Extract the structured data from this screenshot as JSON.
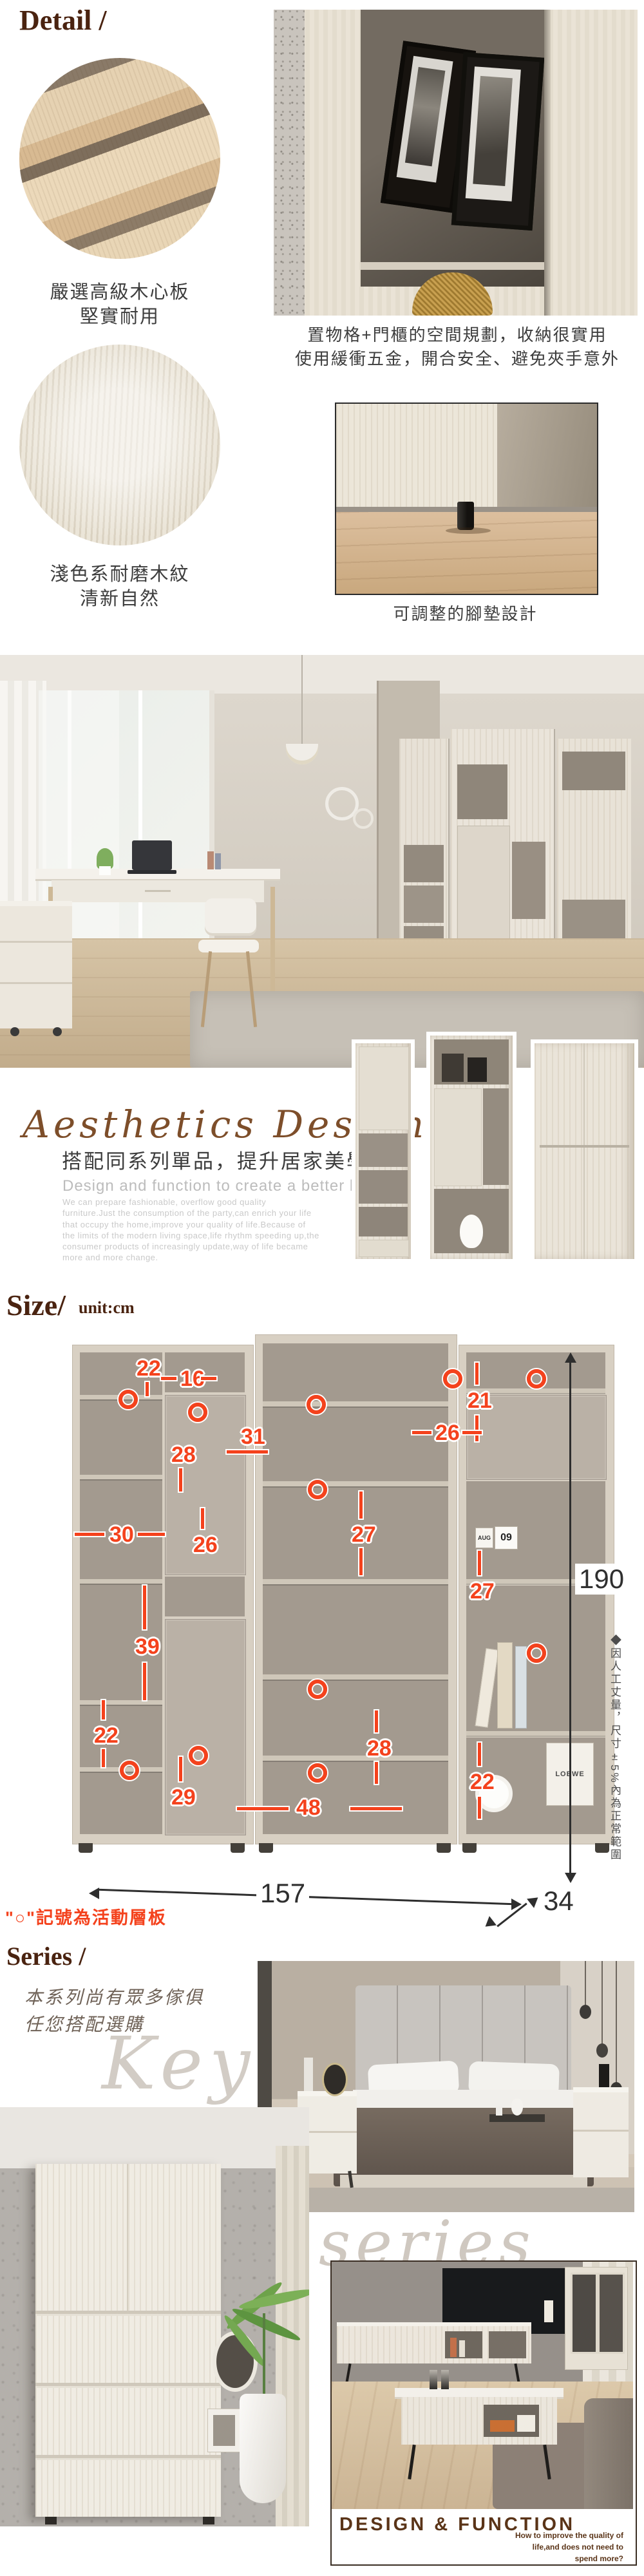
{
  "detail": {
    "title": "Detail /",
    "material_captions": [
      {
        "line1": "嚴選高級木心板",
        "line2": "堅實耐用"
      },
      {
        "line1": "淺色系耐磨木紋",
        "line2": "清新自然"
      }
    ],
    "photo_caption_1a": "置物格+門櫃的空間規劃，收納很實用",
    "photo_caption_1b": "使用緩衝五金，開合安全、避免夾手意外",
    "photo_caption_2": "可調整的腳墊設計"
  },
  "aesthetics": {
    "script_title": "Aesthetics Design",
    "headline": "搭配同系列單品，提升居家美學",
    "subheadline": "Design and function to create a better life.",
    "paragraph": "We can prepare fashionable, overflow good quality furniture.Just the consumption of the party,can enrich your life that occupy the home,improve your quality of life.Because of the limits of the modern living space,life rhythm speeding up,the consumer products of increasingly update,way of life became more and more change."
  },
  "size": {
    "title": "Size/",
    "unit": "unit:cm",
    "overall": {
      "width": "157",
      "depth": "34",
      "height": "190"
    },
    "dims": [
      "22",
      "16",
      "28",
      "31",
      "21",
      "26",
      "30",
      "26",
      "27",
      "39",
      "27",
      "22",
      "29",
      "48",
      "28",
      "22"
    ],
    "red_note": "\"○\"記號為活動層板",
    "vertical_note": "◆因人工丈量，尺寸±5%內為正常範圍",
    "accent_red": "#f4421d",
    "props": {
      "calendar_month": "AUG",
      "calendar_day": "09",
      "clock_brand": "LOEWE"
    }
  },
  "series": {
    "title": "Series /",
    "desc_line1": "本系列尚有眾多傢俱",
    "desc_line2": "任您搭配選購",
    "watermark_1": "Keya",
    "watermark_2": "series",
    "footer_title": "DESIGN & FUNCTION",
    "footer_line1": "How to improve the quality of",
    "footer_line2": "life,and does not need to",
    "footer_line3": "spend more?"
  },
  "colors": {
    "title_brown": "#4a2310",
    "script_brown": "#7d4e2a",
    "red": "#f4421d",
    "footer_brown": "#5a3418"
  }
}
